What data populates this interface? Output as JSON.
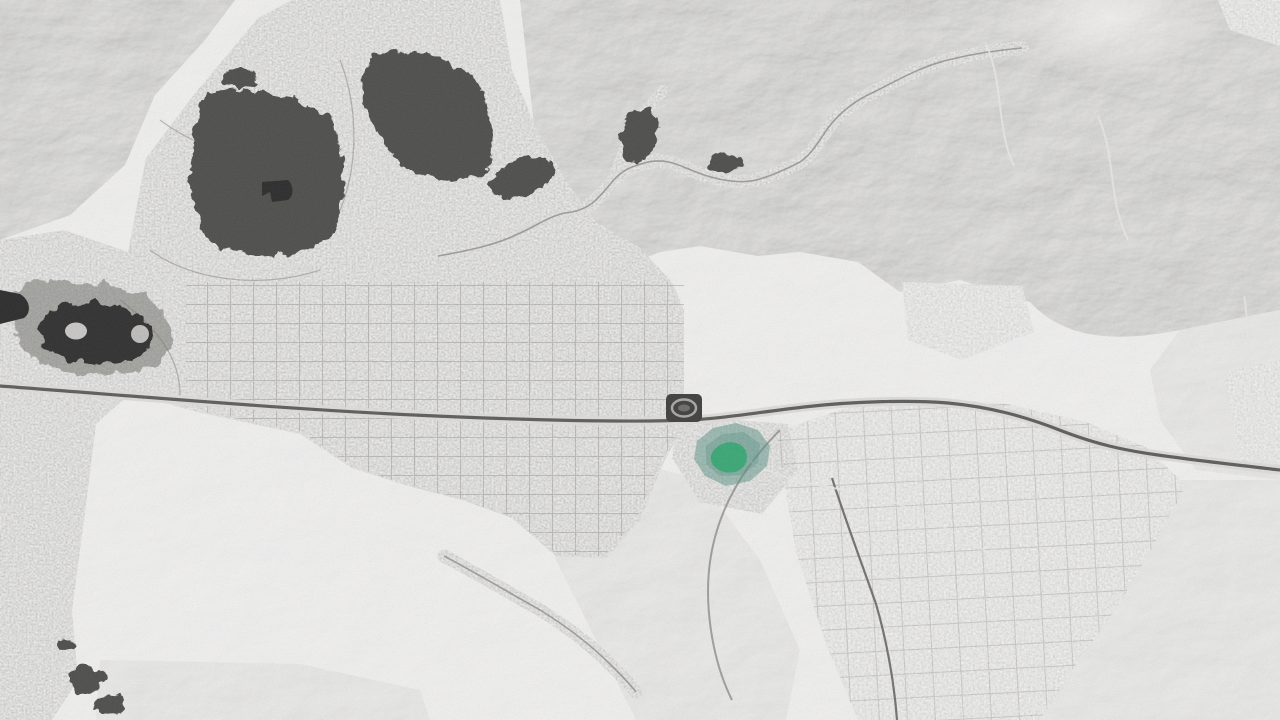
{
  "scene": {
    "kind": "satellite-aerial-photo",
    "description": "Grayscale satellite view of a desert city between mountain ridges; one neighborhood is highlighted in teal-green near the center",
    "width_px": 1280,
    "height_px": 720
  },
  "palette": {
    "base": "#d6d4d2",
    "mountain": "#9a9896",
    "desert": "#e0dedc",
    "city": "#c6c4c2",
    "city_far": "#d8d6d4",
    "vegetation": "#4a4a46",
    "vegetation_soft": "#6e6e6a",
    "lake": "#2c2c2c",
    "pond": "#262626",
    "island": "#c8c6c4",
    "peninsula": "#bdbbb9",
    "highway_core": "#585856",
    "highway_verge": "#dddbd9",
    "road_minor": "#6f6d6b",
    "road_light": "#e8e7e5",
    "street_grid": "#8e8c8a",
    "street_curvy": "#8a8886",
    "stadium": "#3a3a38",
    "stadium_track": "#a8a6a4",
    "stadium_infield": "#6a6866",
    "highlight_outer": "#4f8d7d",
    "highlight_inner": "#2fa56e",
    "bright_patch": "#f2f1ef"
  },
  "features": [
    {
      "name": "mountains-northwest"
    },
    {
      "name": "mountains-north-east-mass"
    },
    {
      "name": "hills-east-mid"
    },
    {
      "name": "desert-hills-southwest"
    },
    {
      "name": "ridge-south-central"
    },
    {
      "name": "hills-southeast"
    },
    {
      "name": "city-grid-main"
    },
    {
      "name": "city-southeast"
    },
    {
      "name": "subdivision-northeast"
    },
    {
      "name": "canyon-settlement-road"
    },
    {
      "name": "foothill-settlement-road-south"
    },
    {
      "name": "lake-with-island"
    },
    {
      "name": "pond-west-edge"
    },
    {
      "name": "golf-course-pentagon"
    },
    {
      "name": "golf-course-north"
    },
    {
      "name": "main-highway"
    },
    {
      "name": "stadium-running-track"
    },
    {
      "name": "highlighted-neighborhood"
    }
  ]
}
